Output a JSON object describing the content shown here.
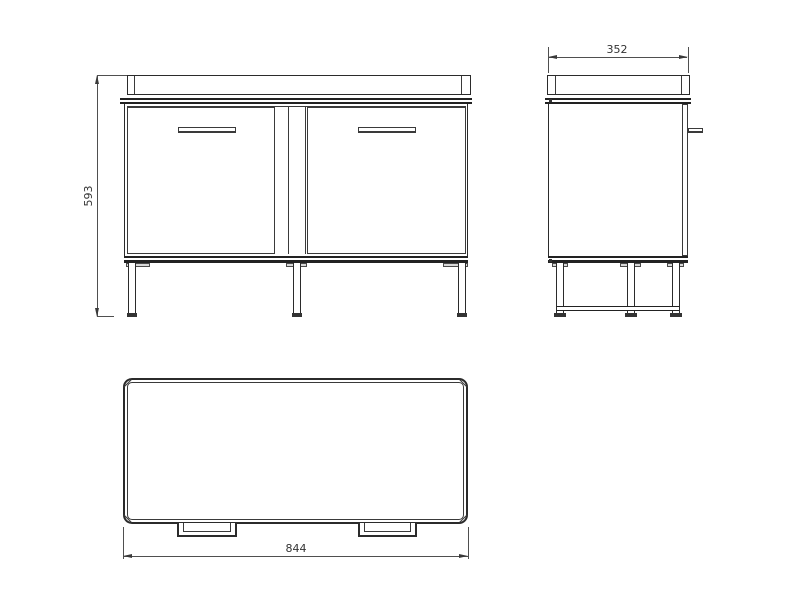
{
  "drawing": {
    "type": "technical-drawing-cabinet-three-views",
    "background": "#ffffff",
    "object_line_color": "#2b2b2b",
    "dimension_line_color": "#4f4f4f",
    "views": {
      "front": {
        "height_dimension": "593"
      },
      "side": {
        "depth_dimension": "352"
      },
      "top": {
        "width_dimension": "844"
      }
    }
  }
}
